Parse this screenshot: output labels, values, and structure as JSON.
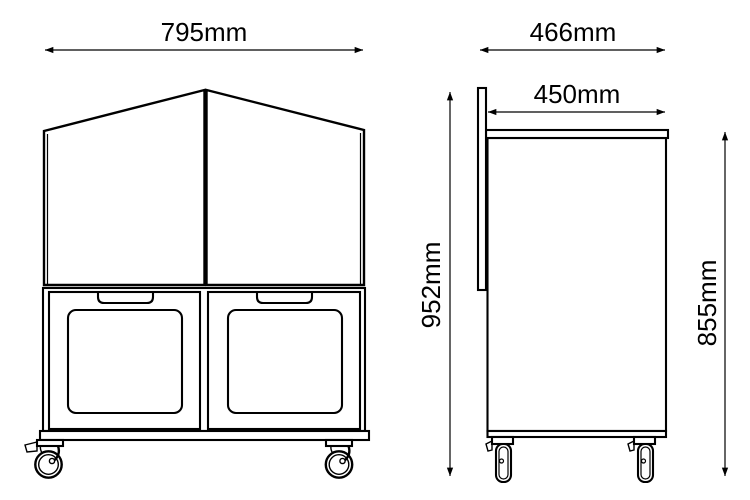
{
  "diagram": {
    "dimensions": {
      "front_width": "795mm",
      "side_depth_overall": "466mm",
      "side_depth_top": "450mm",
      "side_height_overall": "952mm",
      "side_height_body": "855mm"
    },
    "colors": {
      "line": "#000000",
      "background": "#ffffff"
    }
  }
}
